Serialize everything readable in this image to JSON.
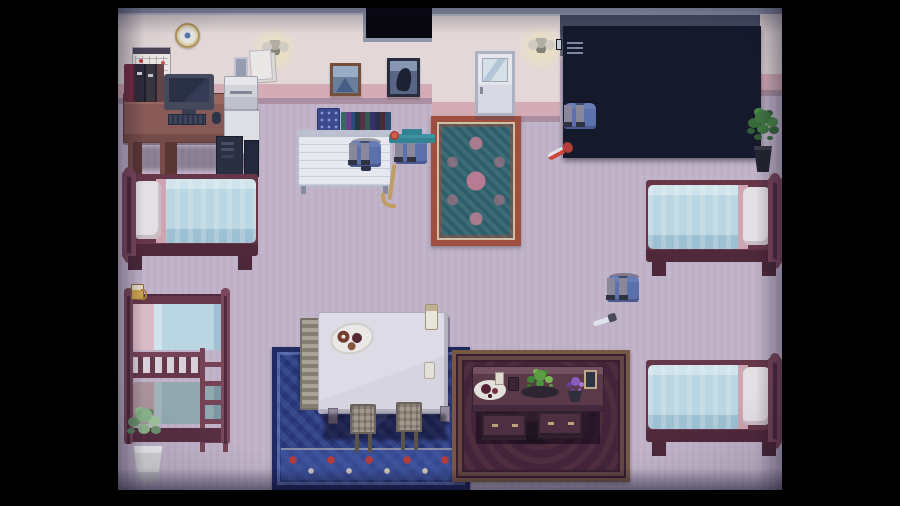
{
  "scene": {
    "title": "Pixel RPG dormitory room scene",
    "objects": {
      "clock": "wall clock",
      "calendar": "wall calendar",
      "lamp": "wall lamp",
      "papers": "pinned notes",
      "mini_frame": "small wall frame",
      "desk": "computer desk",
      "books": "books and binders",
      "monitor": "computer monitor",
      "keyboard": "keyboard",
      "mouse": "mouse",
      "printer": "printer",
      "cabinet": "white cabinet",
      "tower": "PC tower",
      "speaker": "speaker",
      "whiteboard": "whiteboard with shelf of books",
      "painting_mountain": "mountain painting",
      "painting_portrait": "portrait painting",
      "door": "white door",
      "rug_teal": "ornate teal rug",
      "lockers": "metal lockers",
      "plant_right": "potted plant",
      "plant_left": "potted plant in white pot",
      "bed_top_left": "single bed",
      "bed_top_right": "single bed",
      "bed_bottom_right": "single bed",
      "bunk_bed": "bunk bed with ladder",
      "mug": "mug on bunk post",
      "dining_table": "dining table",
      "plate": "plate of pastries",
      "candle": "candle",
      "cup": "cup",
      "chairs_left": "stacked chairs",
      "chair": "chair",
      "rug_blue": "blue ornamental rug",
      "carpet_red": "dark red ornamental carpet",
      "side_table": "dark wooden table with food",
      "side_plate": "plate of food",
      "salad": "bowl of greens",
      "flowers": "purple flowers in pot",
      "photo": "photo frame"
    },
    "characters": {
      "a": "student in blue uniform with bow",
      "b": "student with teal graduation cap holding a cane",
      "c": "brown-haired student holding a red knife",
      "d": "gray-haired student holding a knife"
    }
  },
  "palette": {
    "letterbox": "#000000",
    "floor": "#c9bacf",
    "wall_cream": "#ece1dd",
    "stripe_pink": "#dfb3ba",
    "stripe_mauve": "#b194a6",
    "trim_gray": "#949bad",
    "dark_wall": "#4a4f62",
    "locker_body": "#272f47",
    "wood_maroon": "#6b3647",
    "wood_maroon_dark": "#4e2736",
    "blanket_cyan": "#bfdfe9",
    "pillow_white": "#eee8e9",
    "desk_wood": "#8f5c55",
    "uniform_blue": "#5d74b2",
    "pants_gray": "#8d8d9d",
    "skin": "#e9d9c9",
    "hair_navy": "#2c3349",
    "hair_brown": "#8a6a4a",
    "hair_gray": "#6d6570",
    "cap_teal": "#2f8a98",
    "rug_teal": "#2f6671",
    "rug_rust": "#a8503c",
    "rug_pink": "#c07f93",
    "rug_blue": "#2b3d85",
    "carpet_maroon": "#452338",
    "table_light": "#dedde6",
    "table_dark": "#5d3a47",
    "plant_green": "#3f7c3c",
    "glow_warm": "#f4e8c8",
    "accent_red": "#c23c33"
  }
}
